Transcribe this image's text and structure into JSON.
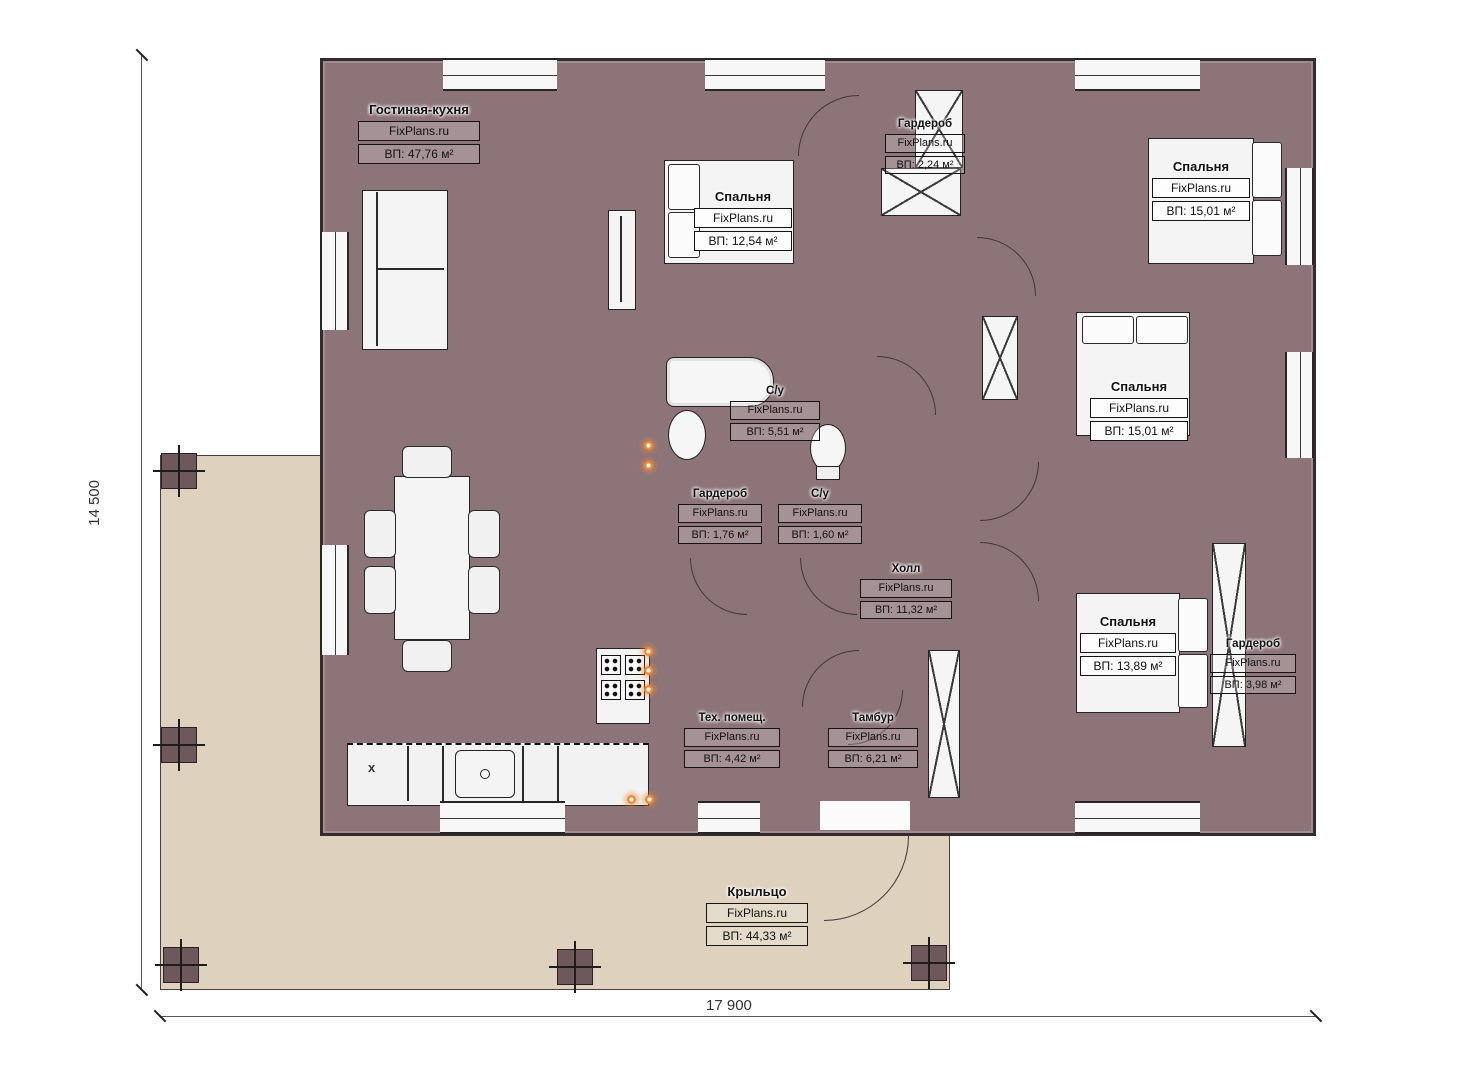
{
  "dimensions": {
    "width_label": "17 900",
    "height_label": "14 500"
  },
  "brand": "FixPlans.ru",
  "kitchen_mark": "х",
  "rooms": [
    {
      "id": "living",
      "name": "Гостиная-кухня",
      "brand": "FixPlans.ru",
      "area": "ВП: 47,76 м²"
    },
    {
      "id": "bedroom-top",
      "name": "Спальня",
      "brand": "FixPlans.ru",
      "area": "ВП: 12,54 м²"
    },
    {
      "id": "wardrobe-top",
      "name": "Гардероб",
      "brand": "FixPlans.ru",
      "area": "ВП: 2,24 м²"
    },
    {
      "id": "bedroom-right-top",
      "name": "Спальня",
      "brand": "FixPlans.ru",
      "area": "ВП: 15,01 м²"
    },
    {
      "id": "bedroom-right-middle",
      "name": "Спальня",
      "brand": "FixPlans.ru",
      "area": "ВП: 15,01 м²"
    },
    {
      "id": "bathroom-main",
      "name": "С/у",
      "brand": "FixPlans.ru",
      "area": "ВП: 5,51 м²"
    },
    {
      "id": "wardrobe-middle",
      "name": "Гардероб",
      "brand": "FixPlans.ru",
      "area": "ВП: 1,76 м²"
    },
    {
      "id": "bathroom-small",
      "name": "С/у",
      "brand": "FixPlans.ru",
      "area": "ВП: 1,60 м²"
    },
    {
      "id": "hall",
      "name": "Холл",
      "brand": "FixPlans.ru",
      "area": "ВП: 11,32 м²"
    },
    {
      "id": "bedroom-right-bottom",
      "name": "Спальня",
      "brand": "FixPlans.ru",
      "area": "ВП: 13,89 м²"
    },
    {
      "id": "wardrobe-right",
      "name": "Гардероб",
      "brand": "FixPlans.ru",
      "area": "ВП: 3,98 м²"
    },
    {
      "id": "tech-room",
      "name": "Тех. помещ.",
      "brand": "FixPlans.ru",
      "area": "ВП: 4,42 м²"
    },
    {
      "id": "tambour",
      "name": "Тамбур",
      "brand": "FixPlans.ru",
      "area": "ВП: 6,21 м²"
    },
    {
      "id": "porch",
      "name": "Крыльцо",
      "brand": "FixPlans.ru",
      "area": "ВП: 44,33 м²"
    }
  ],
  "colors": {
    "wall": "#8c7478",
    "living_floor": "#d2bc95",
    "hall_floor": "#cdb88f",
    "bedroom_floor": "#8a7557",
    "bath_floor": "#b9d4ee",
    "tech_floor": "#dcdcdc",
    "porch": "#ded1bd",
    "column": "#6e585c",
    "furniture": "#f4f4f4",
    "accent_dot": "#ed8b3d"
  }
}
